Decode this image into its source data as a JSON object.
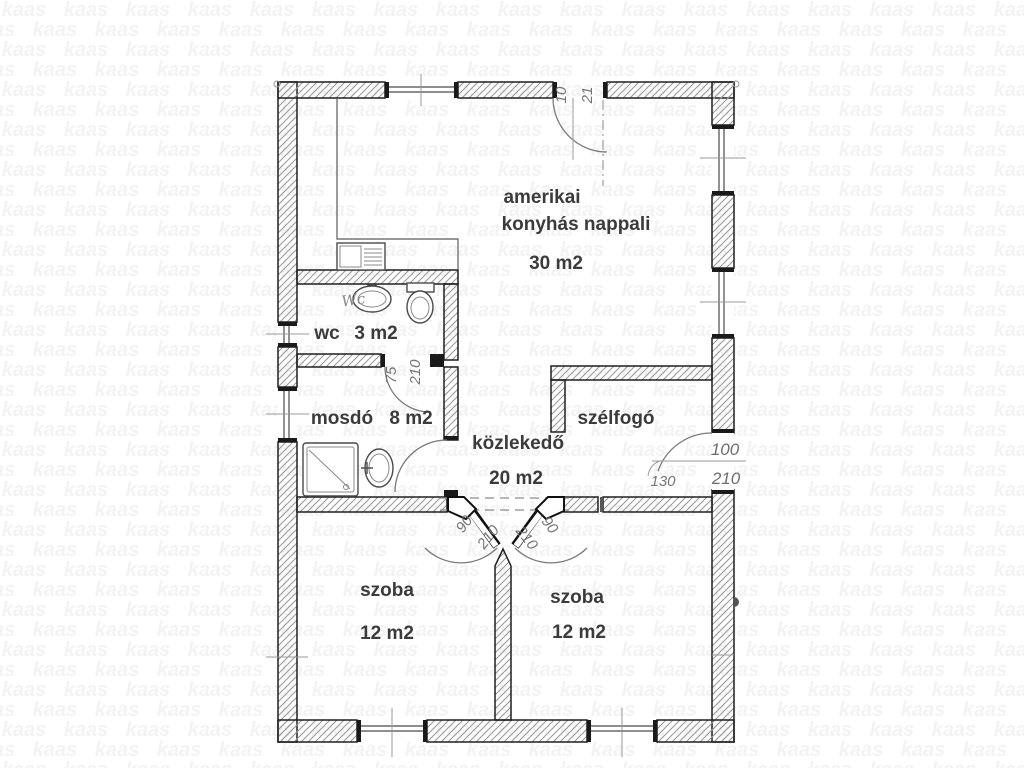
{
  "watermark": {
    "text": "kaas"
  },
  "plan": {
    "rooms": {
      "living": {
        "name_line1": "amerikai",
        "name_line2": "konyhás nappali",
        "area": "30 m2"
      },
      "wc": {
        "name": "wc",
        "area": "3 m2"
      },
      "bath": {
        "name": "mosdó",
        "area": "8 m2"
      },
      "hall": {
        "name": "közlekedő",
        "area": "20 m2"
      },
      "entry": {
        "name": "szélfogó"
      },
      "room_left": {
        "name": "szoba",
        "area": "12 m2"
      },
      "room_right": {
        "name": "szoba",
        "area": "12 m2"
      }
    },
    "dims": {
      "top_door_w": "10",
      "top_door_h": "21",
      "wc_door_w": "75",
      "wc_door_h": "210",
      "entry_door_w": "100",
      "entry_door_h": "210",
      "entry_side": "130",
      "room_left_door_w": "90",
      "room_left_door_h": "210",
      "room_right_door_w": "90",
      "room_right_door_h": "210"
    },
    "fixture_labels": {
      "wc_basin": "Wc"
    }
  },
  "colors": {
    "wall_line": "#1f1f1f",
    "hatch": "#999999",
    "label_text": "#3b3b3b",
    "dim_text": "#757575",
    "watermark": "#f3f3f3"
  }
}
